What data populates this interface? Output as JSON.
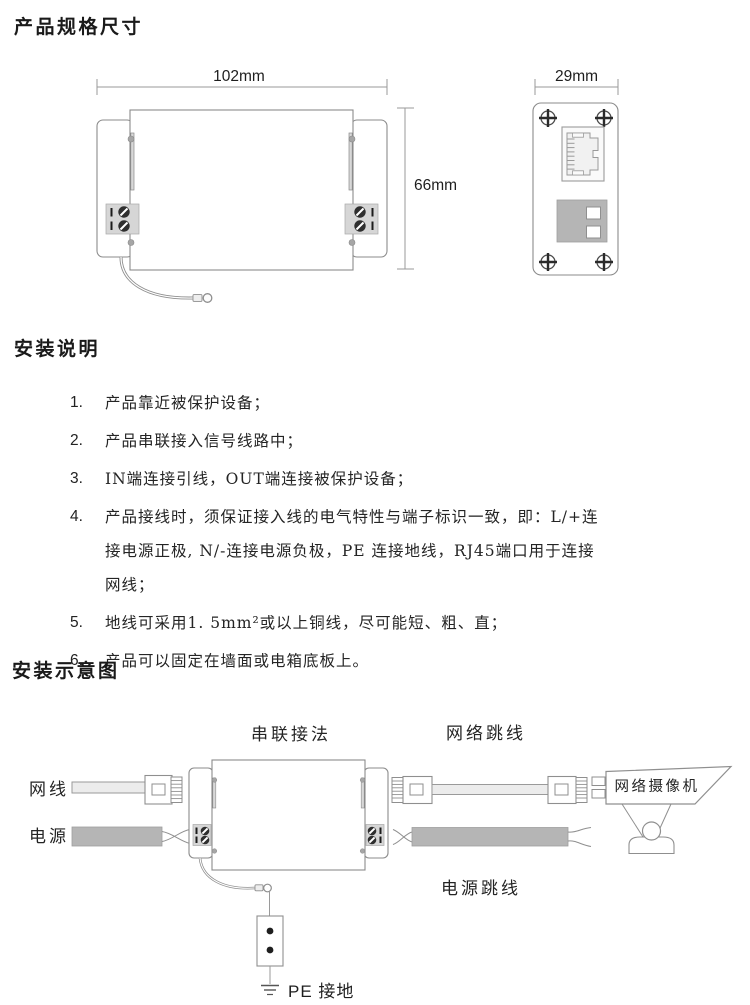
{
  "sections": {
    "dimensions": {
      "title": "产品规格尺寸",
      "front_view": {
        "width_label": "102mm",
        "height_label": "66mm"
      },
      "side_view": {
        "width_label": "29mm"
      }
    },
    "instructions": {
      "title": "安装说明",
      "items": [
        {
          "num": "1.",
          "text": "产品靠近被保护设备；"
        },
        {
          "num": "2.",
          "text": "产品串联接入信号线路中；"
        },
        {
          "num": "3.",
          "text": "IN端连接引线，OUT端连接被保护设备；"
        },
        {
          "num": "4.",
          "text": "产品接线时，须保证接入线的电气特性与端子标识一致，即：L/+连接电源正极, N/-连接电源负极，PE 连接地线，RJ45端口用于连接网线；"
        },
        {
          "num": "5.",
          "text": "地线可采用1. 5mm²或以上铜线，尽可能短、粗、直；"
        },
        {
          "num": "6.",
          "text": "产品可以固定在墙面或电箱底板上。"
        }
      ]
    },
    "diagram": {
      "title": "安装示意图",
      "labels": {
        "series_connection": "串联接法",
        "network_jumper": "网络跳线",
        "network_cable": "网线",
        "power": "电源",
        "power_jumper": "电源跳线",
        "network_camera": "网络摄像机",
        "pe_ground": "PE 接地"
      }
    },
    "colors": {
      "line": "#8b8b8b",
      "gray_fill": "#b5b5b5",
      "block_fill": "#d6d6d6",
      "text": "#1f1f1f"
    }
  }
}
